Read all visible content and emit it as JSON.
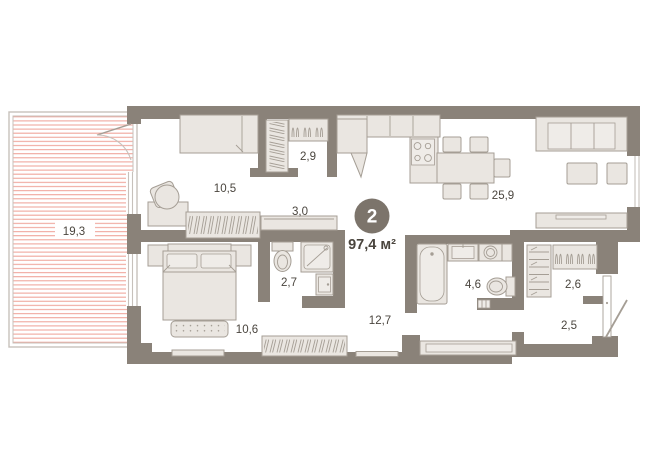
{
  "badge": {
    "rooms": "2",
    "area": "97,4 м²"
  },
  "rooms": [
    {
      "name": "terrace",
      "area": "19,3"
    },
    {
      "name": "bedroom-small",
      "area": "10,5"
    },
    {
      "name": "wardrobe-top",
      "area": "2,9"
    },
    {
      "name": "hall",
      "area": "3,0"
    },
    {
      "name": "kitchen-living",
      "area": "25,9"
    },
    {
      "name": "shower-room",
      "area": "2,7"
    },
    {
      "name": "bathroom",
      "area": "4,6"
    },
    {
      "name": "wardrobe-entry",
      "area": "2,6"
    },
    {
      "name": "entry-hall",
      "area": "2,5"
    },
    {
      "name": "bedroom-main",
      "area": "10,6"
    },
    {
      "name": "corridor",
      "area": "12,7"
    }
  ],
  "colors": {
    "bg": "#ffffff",
    "wall": "#8a8279",
    "furniture_fill": "#eae6e1",
    "furniture_fill_light": "#efece8",
    "furniture_stroke": "#a59e95",
    "hatch_red": "#f0a79d",
    "glass": "#c7c1bb",
    "label_text": "#4a453e",
    "badge_bg": "#7c746b",
    "badge_text": "#ffffff"
  }
}
